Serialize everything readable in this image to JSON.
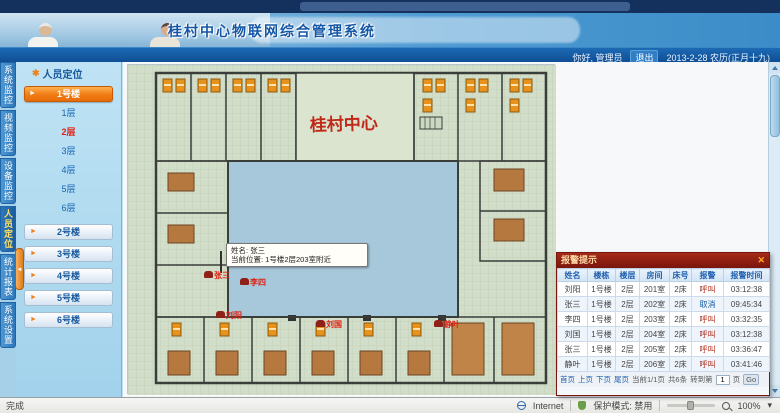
{
  "header": {
    "title": "桂村中心物联网综合管理系统",
    "greeting": "你好, 管理员",
    "logout_label": "退出",
    "date_text": "2013-2-28 农历(正月十九)"
  },
  "nav": {
    "tabs": [
      {
        "label": "系统监控"
      },
      {
        "label": "视频监控"
      },
      {
        "label": "设备监控"
      },
      {
        "label": "人员定位",
        "active": true
      },
      {
        "label": "统计报表"
      },
      {
        "label": "系统设置"
      }
    ]
  },
  "sidebar": {
    "panel_title": "人员定位",
    "expanded_building": "1号楼",
    "floors": [
      {
        "label": "1层"
      },
      {
        "label": "2层",
        "active": true
      },
      {
        "label": "3层"
      },
      {
        "label": "4层"
      },
      {
        "label": "5层"
      },
      {
        "label": "6层"
      }
    ],
    "buildings": [
      "2号楼",
      "3号楼",
      "4号楼",
      "5号楼",
      "6号楼"
    ]
  },
  "plan": {
    "calligraphy": "桂村中心",
    "tooltip": {
      "line1": "姓名: 张三",
      "line2": "当前位置: 1号楼2层203室附近"
    },
    "markers": [
      {
        "name": "张三"
      },
      {
        "name": "李四"
      },
      {
        "name": "刘阳"
      },
      {
        "name": "刘国"
      },
      {
        "name": "静叶"
      }
    ]
  },
  "alert_panel": {
    "title": "报警提示",
    "close_label": "✕",
    "columns": [
      "姓名",
      "楼栋",
      "楼层",
      "房间",
      "床号",
      "报警",
      "报警时间"
    ],
    "rows": [
      {
        "name": "刘阳",
        "building": "1号楼",
        "floor": "2层",
        "room": "201室",
        "bed": "2床",
        "type": "呼叫",
        "time": "03:12:38"
      },
      {
        "name": "张三",
        "building": "1号楼",
        "floor": "2层",
        "room": "202室",
        "bed": "2床",
        "type": "取消",
        "time": "09:45:34"
      },
      {
        "name": "李四",
        "building": "1号楼",
        "floor": "2层",
        "room": "203室",
        "bed": "2床",
        "type": "呼叫",
        "time": "03:32:35"
      },
      {
        "name": "刘国",
        "building": "1号楼",
        "floor": "2层",
        "room": "204室",
        "bed": "2床",
        "type": "呼叫",
        "time": "03:12:38"
      },
      {
        "name": "张三",
        "building": "1号楼",
        "floor": "2层",
        "room": "205室",
        "bed": "2床",
        "type": "呼叫",
        "time": "03:36:47"
      },
      {
        "name": "静叶",
        "building": "1号楼",
        "floor": "2层",
        "room": "206室",
        "bed": "2床",
        "type": "呼叫",
        "time": "03:41:46"
      }
    ],
    "pagination": {
      "first": "首页",
      "prev": "上页",
      "next": "下页",
      "last": "尾页",
      "current": "当前1/1页",
      "total": "共6条",
      "goto_label": "转到第",
      "page_value": "1",
      "unit": "页",
      "go": "Go"
    }
  },
  "statusbar": {
    "left": "完成",
    "zone": "Internet",
    "protected": "保护模式: 禁用",
    "zoom": "100%",
    "caret": "▾"
  },
  "colors": {
    "accent_orange": "#f07c14",
    "alert_red": "#8e2018",
    "active_floor_red": "#e01f10",
    "header_blue": "#1456a6",
    "courtyard_blue": "#a6c8da"
  }
}
